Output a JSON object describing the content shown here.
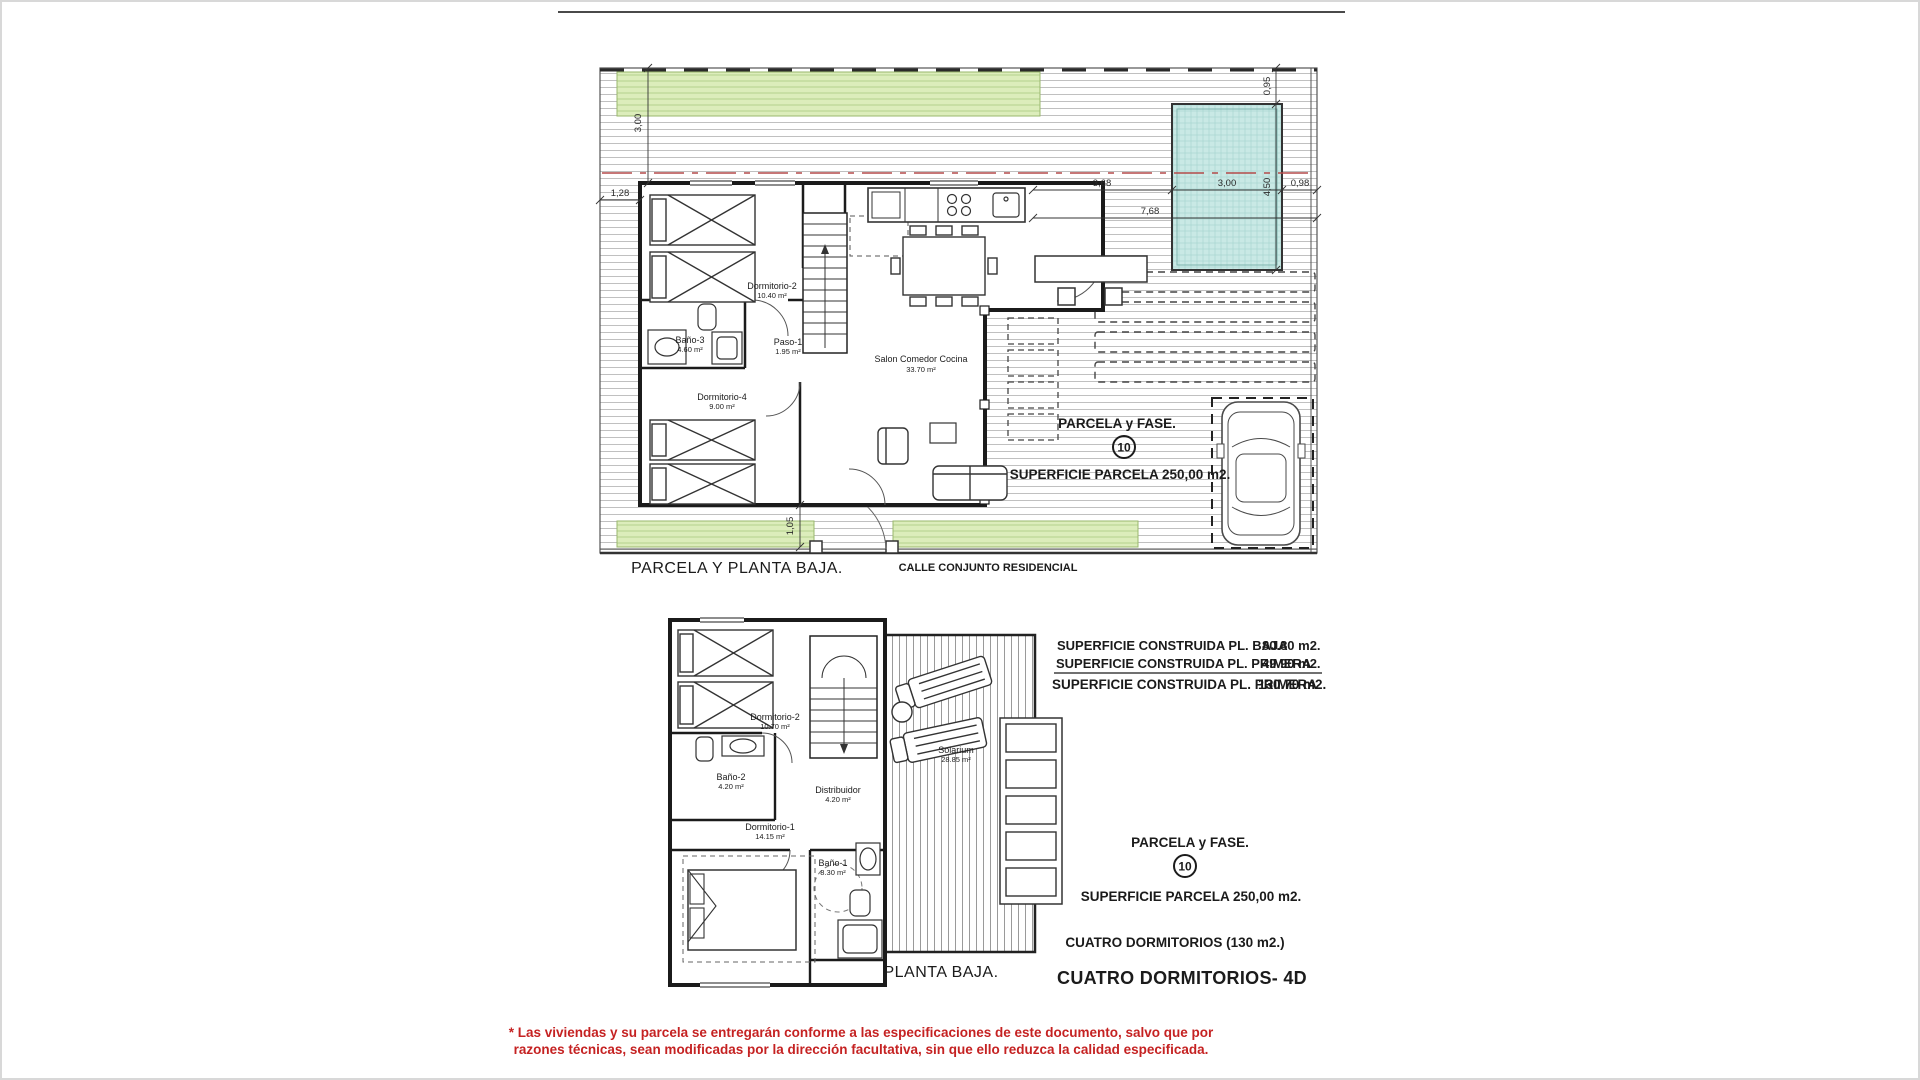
{
  "colors": {
    "lawn_green": "#dcedbb",
    "pool_teal": "#c9e9e5",
    "setback_red": "#b34a4a",
    "disclaimer_red": "#c52222",
    "ink": "#1b1b1b",
    "hatch_gray": "#bbbbbb"
  },
  "top_plan": {
    "caption": "PARCELA Y PLANTA BAJA.",
    "street_label": "CALLE CONJUNTO RESIDENCIAL",
    "parcela_fase": "PARCELA y FASE.",
    "fase_number": "10",
    "superficie_parcela": "SUPERFICIE PARCELA 250,00 m2.",
    "rooms": {
      "dormitorio2": {
        "name": "Dormitorio-2",
        "area": "10.40 m²"
      },
      "bano3": {
        "name": "Baño-3",
        "area": "4.60 m²"
      },
      "paso1": {
        "name": "Paso-1",
        "area": "1.95 m²"
      },
      "dormitorio4": {
        "name": "Dormitorio-4",
        "area": "9.00 m²"
      },
      "salon": {
        "name": "Salon Comedor Cocina",
        "area": "33.70 m²"
      }
    },
    "dimensions": {
      "setback_left": "1,28",
      "lawn_depth": "3,00",
      "house_to_pool": "3,68",
      "pool_width": "3,00",
      "pool_to_boundary": "0,98",
      "total_right": "7,68",
      "boundary_to_pool": "0,95",
      "pool_length": "4,50",
      "rear_strip": "1,05"
    }
  },
  "bottom_plan": {
    "caption": "PLANTA BAJA.",
    "built_areas": [
      {
        "label": "SUPERFICIE CONSTRUIDA PL. BAJA",
        "value": "80.80 m2."
      },
      {
        "label": "SUPERFICIE CONSTRUIDA PL. PRIMERA",
        "value": "49.90 m2."
      },
      {
        "label": "SUPERFICIE CONSTRUIDA PL. PRIMERA",
        "value": "130.70  m2."
      }
    ],
    "parcela_fase": "PARCELA y FASE.",
    "fase_number": "10",
    "superficie_parcela": "SUPERFICIE PARCELA 250,00 m2.",
    "tipologia": "CUATRO DORMITORIOS (130 m2.)",
    "modelo": "CUATRO DORMITORIOS- 4D",
    "rooms": {
      "dormitorio2": {
        "name": "Dormitorio-2",
        "area": "10.70 m²"
      },
      "bano2": {
        "name": "Baño-2",
        "area": "4.20 m²"
      },
      "distribuidor": {
        "name": "Distribuidor",
        "area": "4.20 m²"
      },
      "dormitorio1": {
        "name": "Dormitorio-1",
        "area": "14.15 m²"
      },
      "bano1": {
        "name": "Baño-1",
        "area": "8.30 m²"
      },
      "solarium": {
        "name": "Solarium",
        "area": "28.85 m²"
      }
    }
  },
  "disclaimer": {
    "line1": "* Las viviendas y su parcela se entregarán conforme a las especificaciones de este documento, salvo que por",
    "line2": "razones técnicas, sean modificadas por la dirección facultativa, sin que ello reduzca la calidad especificada."
  }
}
